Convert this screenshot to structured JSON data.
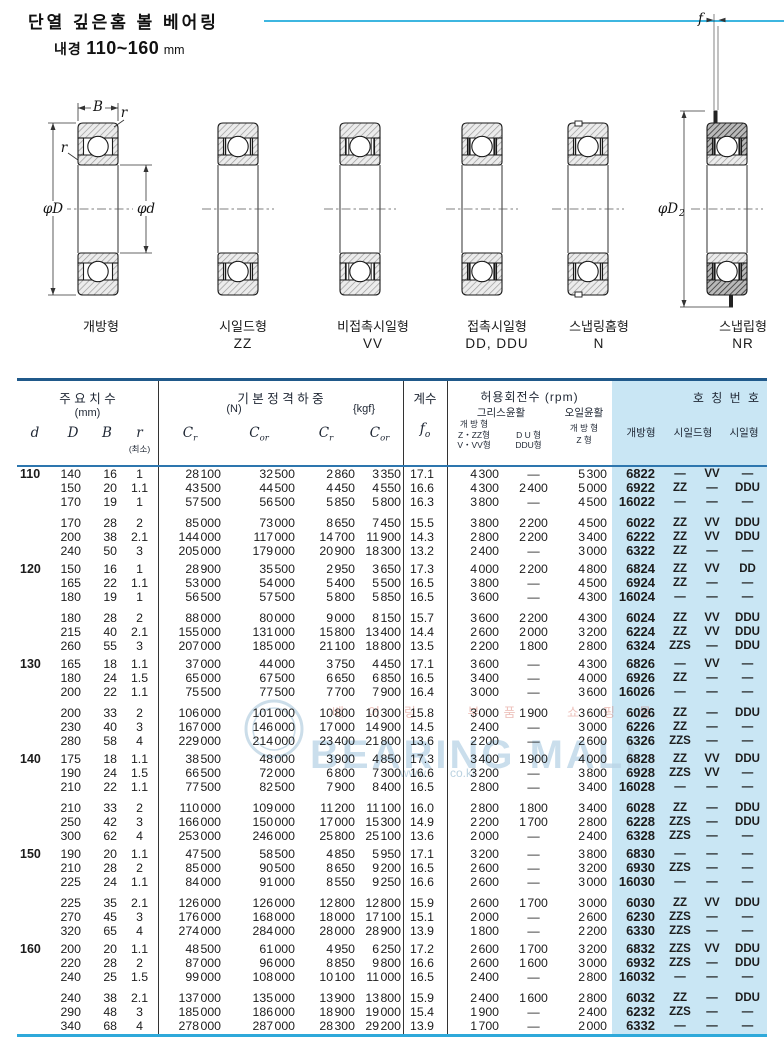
{
  "title": "단열 깊은홈 볼 베어링",
  "subtitle": {
    "label": "내경",
    "range": "110~160",
    "unit": "mm"
  },
  "watermark": {
    "main": "BEARING MALL",
    "sub": "베어링 부품 쇼핑몰",
    "url_left": "www.",
    "url_right": "co.kr"
  },
  "diagram": {
    "dims": {
      "B": "B",
      "r1": "r",
      "r2": "r",
      "phiD": "φD",
      "phid": "φd",
      "f": "f",
      "phiD2": "φD",
      "phiD2_sub": "2"
    },
    "types": [
      {
        "label": "개방형",
        "code": ""
      },
      {
        "label": "시일드형",
        "code": "ZZ"
      },
      {
        "label": "비접촉시일형",
        "code": "VV"
      },
      {
        "label": "접촉시일형",
        "code": "DD, DDU"
      },
      {
        "label": "스냅링홈형",
        "code": "N"
      },
      {
        "label": "스냅립형",
        "code": "NR"
      }
    ]
  },
  "table": {
    "header": {
      "dims": {
        "title": "주 요 치 수",
        "unit": "(mm)",
        "d": "d",
        "D": "D",
        "B": "B",
        "r": "r",
        "r_min": "(최소)"
      },
      "loads": {
        "title": "기 본 정 격 하 중",
        "unit_n": "(N)",
        "unit_kgf": "{kgf}",
        "c": "C",
        "sub_r": "r",
        "sub_or": "or"
      },
      "coef": {
        "title": "계수",
        "f": "f",
        "sub": "o"
      },
      "speed": {
        "title": "허용회전수 (rpm)",
        "grease": "그리스윤활",
        "oil": "오일윤활",
        "col1": [
          "개 방 형",
          "Z・ZZ형",
          "V・VV형"
        ],
        "col2": [
          "D U 형",
          "DDU형"
        ],
        "col3": [
          "개 방 형",
          "Z 형"
        ]
      },
      "numbers": {
        "title": "호 칭 번 호",
        "open": "개방형",
        "shield": "시일드형",
        "seal": "시일형"
      }
    },
    "groups": [
      {
        "d": "110",
        "subgroups": [
          [
            [
              "140",
              "16",
              "1",
              "28 100",
              "32 500",
              "2 860",
              "3 350",
              "17.1",
              "4 300",
              "—",
              "5 300",
              "6822",
              "—",
              "VV",
              "—"
            ],
            [
              "150",
              "20",
              "1.1",
              "43 500",
              "44 500",
              "4 450",
              "4 550",
              "16.6",
              "4 300",
              "2 400",
              "5 000",
              "6922",
              "ZZ",
              "—",
              "DDU"
            ],
            [
              "170",
              "19",
              "1",
              "57 500",
              "56 500",
              "5 850",
              "5 800",
              "16.3",
              "3 800",
              "—",
              "4 500",
              "16022",
              "—",
              "—",
              "—"
            ]
          ],
          [
            [
              "170",
              "28",
              "2",
              "85 000",
              "73 000",
              "8 650",
              "7 450",
              "15.5",
              "3 800",
              "2 200",
              "4 500",
              "6022",
              "ZZ",
              "VV",
              "DDU"
            ],
            [
              "200",
              "38",
              "2.1",
              "144 000",
              "117 000",
              "14 700",
              "11 900",
              "14.3",
              "2 800",
              "2 200",
              "3 400",
              "6222",
              "ZZ",
              "VV",
              "DDU"
            ],
            [
              "240",
              "50",
              "3",
              "205 000",
              "179 000",
              "20 900",
              "18 300",
              "13.2",
              "2 400",
              "—",
              "3 000",
              "6322",
              "ZZ",
              "—",
              "—"
            ]
          ]
        ]
      },
      {
        "d": "120",
        "subgroups": [
          [
            [
              "150",
              "16",
              "1",
              "28 900",
              "35 500",
              "2 950",
              "3 650",
              "17.3",
              "4 000",
              "2 200",
              "4 800",
              "6824",
              "ZZ",
              "VV",
              "DD"
            ],
            [
              "165",
              "22",
              "1.1",
              "53 000",
              "54 000",
              "5 400",
              "5 500",
              "16.5",
              "3 800",
              "—",
              "4 500",
              "6924",
              "ZZ",
              "—",
              "—"
            ],
            [
              "180",
              "19",
              "1",
              "56 500",
              "57 500",
              "5 800",
              "5 850",
              "16.5",
              "3 600",
              "—",
              "4 300",
              "16024",
              "—",
              "—",
              "—"
            ]
          ],
          [
            [
              "180",
              "28",
              "2",
              "88 000",
              "80 000",
              "9 000",
              "8 150",
              "15.7",
              "3 600",
              "2 200",
              "4 300",
              "6024",
              "ZZ",
              "VV",
              "DDU"
            ],
            [
              "215",
              "40",
              "2.1",
              "155 000",
              "131 000",
              "15 800",
              "13 400",
              "14.4",
              "2 600",
              "2 000",
              "3 200",
              "6224",
              "ZZ",
              "VV",
              "DDU"
            ],
            [
              "260",
              "55",
              "3",
              "207 000",
              "185 000",
              "21 100",
              "18 800",
              "13.5",
              "2 200",
              "1 800",
              "2 800",
              "6324",
              "ZZS",
              "—",
              "DDU"
            ]
          ]
        ]
      },
      {
        "d": "130",
        "subgroups": [
          [
            [
              "165",
              "18",
              "1.1",
              "37 000",
              "44 000",
              "3 750",
              "4 450",
              "17.1",
              "3 600",
              "—",
              "4 300",
              "6826",
              "—",
              "VV",
              "—"
            ],
            [
              "180",
              "24",
              "1.5",
              "65 000",
              "67 500",
              "6 650",
              "6 850",
              "16.5",
              "3 400",
              "—",
              "4 000",
              "6926",
              "ZZ",
              "—",
              "—"
            ],
            [
              "200",
              "22",
              "1.1",
              "75 500",
              "77 500",
              "7 700",
              "7 900",
              "16.4",
              "3 000",
              "—",
              "3 600",
              "16026",
              "—",
              "—",
              "—"
            ]
          ],
          [
            [
              "200",
              "33",
              "2",
              "106 000",
              "101 000",
              "10 800",
              "10 300",
              "15.8",
              "3 000",
              "1 900",
              "3 600",
              "6026",
              "ZZ",
              "—",
              "DDU"
            ],
            [
              "230",
              "40",
              "3",
              "167 000",
              "146 000",
              "17 000",
              "14 900",
              "14.5",
              "2 400",
              "—",
              "3 000",
              "6226",
              "ZZ",
              "—",
              "—"
            ],
            [
              "280",
              "58",
              "4",
              "229 000",
              "214 000",
              "23 400",
              "21 800",
              "13.6",
              "2 200",
              "—",
              "2 600",
              "6326",
              "ZZS",
              "—",
              "—"
            ]
          ]
        ]
      },
      {
        "d": "140",
        "subgroups": [
          [
            [
              "175",
              "18",
              "1.1",
              "38 500",
              "48 000",
              "3 900",
              "4 850",
              "17.3",
              "3 400",
              "1 900",
              "4 000",
              "6828",
              "ZZ",
              "VV",
              "DDU"
            ],
            [
              "190",
              "24",
              "1.5",
              "66 500",
              "72 000",
              "6 800",
              "7 300",
              "16.6",
              "3 200",
              "—",
              "3 800",
              "6928",
              "ZZS",
              "VV",
              "—"
            ],
            [
              "210",
              "22",
              "1.1",
              "77 500",
              "82 500",
              "7 900",
              "8 400",
              "16.5",
              "2 800",
              "—",
              "3 400",
              "16028",
              "—",
              "—",
              "—"
            ]
          ],
          [
            [
              "210",
              "33",
              "2",
              "110 000",
              "109 000",
              "11 200",
              "11 100",
              "16.0",
              "2 800",
              "1 800",
              "3 400",
              "6028",
              "ZZ",
              "—",
              "DDU"
            ],
            [
              "250",
              "42",
              "3",
              "166 000",
              "150 000",
              "17 000",
              "15 300",
              "14.9",
              "2 200",
              "1 700",
              "2 800",
              "6228",
              "ZZS",
              "—",
              "DDU"
            ],
            [
              "300",
              "62",
              "4",
              "253 000",
              "246 000",
              "25 800",
              "25 100",
              "13.6",
              "2 000",
              "—",
              "2 400",
              "6328",
              "ZZS",
              "—",
              "—"
            ]
          ]
        ]
      },
      {
        "d": "150",
        "subgroups": [
          [
            [
              "190",
              "20",
              "1.1",
              "47 500",
              "58 500",
              "4 850",
              "5 950",
              "17.1",
              "3 200",
              "—",
              "3 800",
              "6830",
              "—",
              "—",
              "—"
            ],
            [
              "210",
              "28",
              "2",
              "85 000",
              "90 500",
              "8 650",
              "9 200",
              "16.5",
              "2 600",
              "—",
              "3 200",
              "6930",
              "ZZS",
              "—",
              "—"
            ],
            [
              "225",
              "24",
              "1.1",
              "84 000",
              "91 000",
              "8 550",
              "9 250",
              "16.6",
              "2 600",
              "—",
              "3 000",
              "16030",
              "—",
              "—",
              "—"
            ]
          ],
          [
            [
              "225",
              "35",
              "2.1",
              "126 000",
              "126 000",
              "12 800",
              "12 800",
              "15.9",
              "2 600",
              "1 700",
              "3 000",
              "6030",
              "ZZ",
              "VV",
              "DDU"
            ],
            [
              "270",
              "45",
              "3",
              "176 000",
              "168 000",
              "18 000",
              "17 100",
              "15.1",
              "2 000",
              "—",
              "2 600",
              "6230",
              "ZZS",
              "—",
              "—"
            ],
            [
              "320",
              "65",
              "4",
              "274 000",
              "284 000",
              "28 000",
              "28 900",
              "13.9",
              "1 800",
              "—",
              "2 200",
              "6330",
              "ZZS",
              "—",
              "—"
            ]
          ]
        ]
      },
      {
        "d": "160",
        "subgroups": [
          [
            [
              "200",
              "20",
              "1.1",
              "48 500",
              "61 000",
              "4 950",
              "6 250",
              "17.2",
              "2 600",
              "1 700",
              "3 200",
              "6832",
              "ZZS",
              "VV",
              "DDU"
            ],
            [
              "220",
              "28",
              "2",
              "87 000",
              "96 000",
              "8 850",
              "9 800",
              "16.6",
              "2 600",
              "1 600",
              "3 000",
              "6932",
              "ZZS",
              "—",
              "DDU"
            ],
            [
              "240",
              "25",
              "1.5",
              "99 000",
              "108 000",
              "10 100",
              "11 000",
              "16.5",
              "2 400",
              "—",
              "2 800",
              "16032",
              "—",
              "—",
              "—"
            ]
          ],
          [
            [
              "240",
              "38",
              "2.1",
              "137 000",
              "135 000",
              "13 900",
              "13 800",
              "15.9",
              "2 400",
              "1 600",
              "2 800",
              "6032",
              "ZZ",
              "—",
              "DDU"
            ],
            [
              "290",
              "48",
              "3",
              "185 000",
              "186 000",
              "18 900",
              "19 000",
              "15.4",
              "1 900",
              "—",
              "2 400",
              "6232",
              "ZZS",
              "—",
              "—"
            ],
            [
              "340",
              "68",
              "4",
              "278 000",
              "287 000",
              "28 300",
              "29 200",
              "13.9",
              "1 700",
              "—",
              "2 000",
              "6332",
              "—",
              "—",
              "—"
            ]
          ]
        ]
      }
    ]
  }
}
